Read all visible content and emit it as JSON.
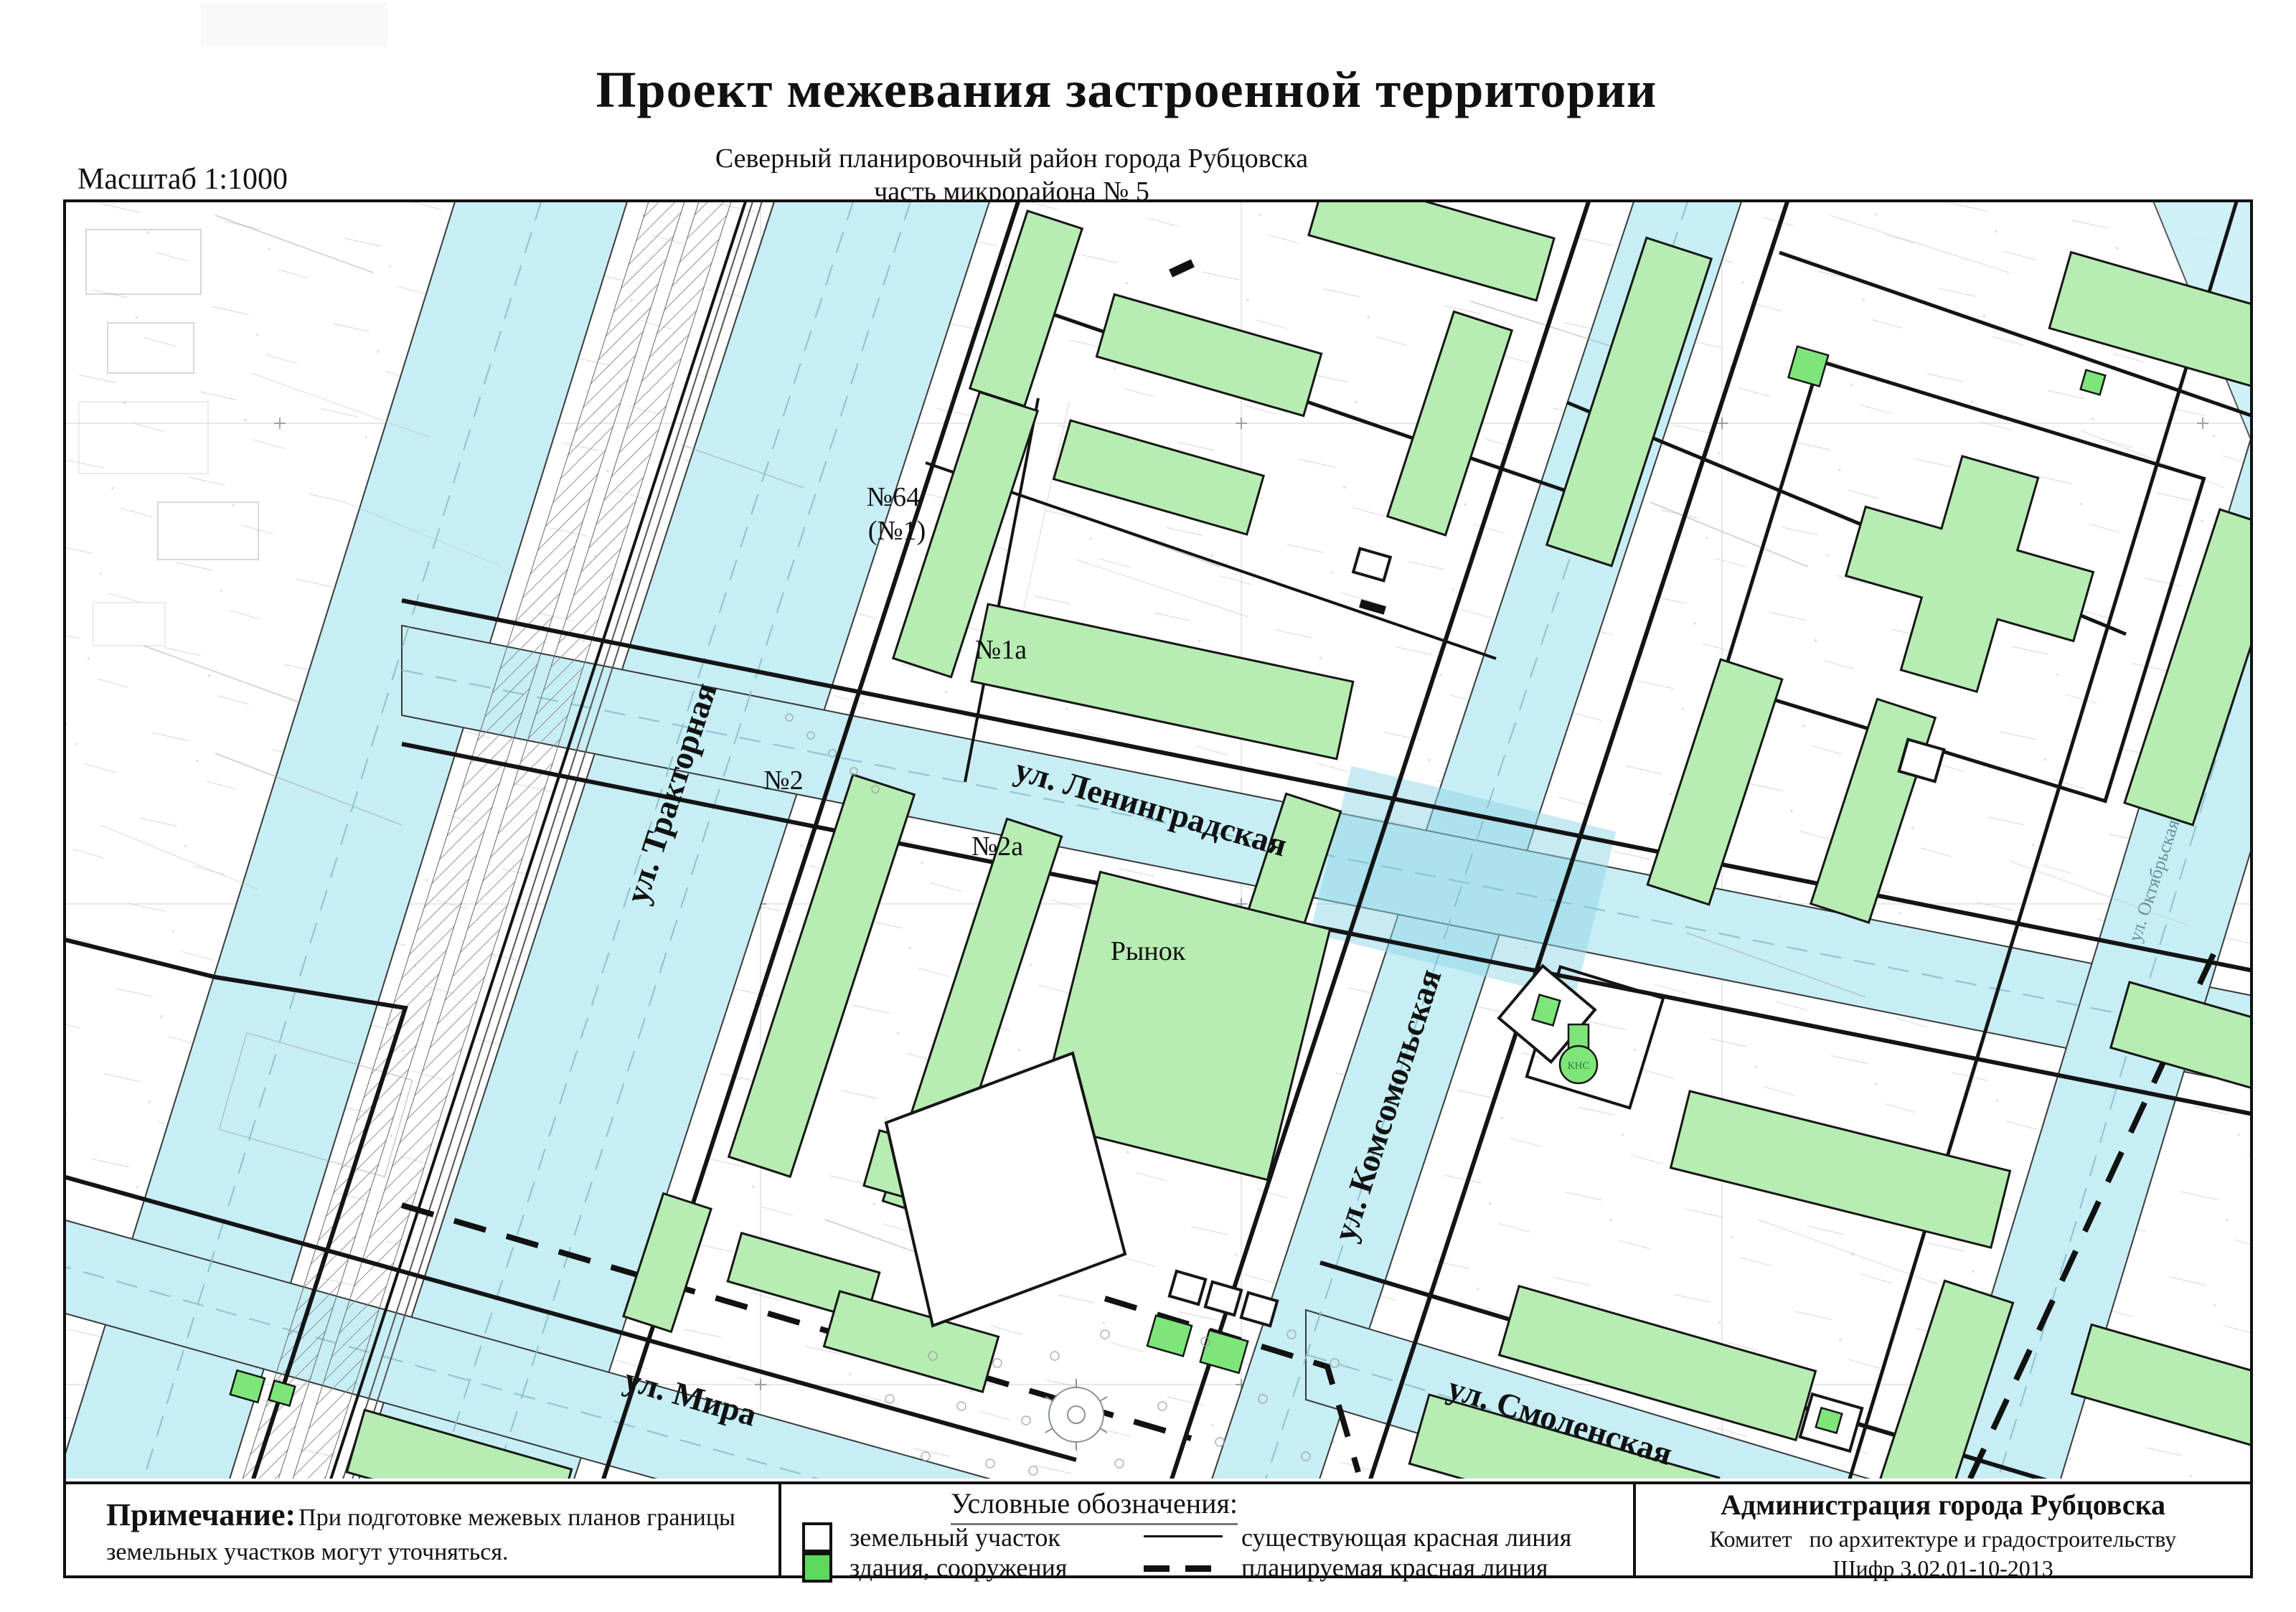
{
  "header": {
    "title": "Проект межевания застроенной территории",
    "subtitle1": "Северный планировочный район города Рубцовска",
    "subtitle2": "часть микрорайона № 5",
    "scale": "Масштаб 1:1000"
  },
  "map": {
    "streets": {
      "traktornaya": "ул. Тракторная",
      "leningradskaya": "ул. Ленинградская",
      "komsomolskaya": "ул. Комсомольская",
      "mira": "ул. Мира",
      "smolenskaya": "ул. Смоленская",
      "oktyabrskaya": "ул. Октябрьская"
    },
    "parcels": {
      "p64a": "№64",
      "p64b": "(№1)",
      "p1a": "№1а",
      "p2": "№2",
      "p2a": "№2а",
      "rynok": "Рынок",
      "kns": "КНС"
    }
  },
  "legend": {
    "title": "Условные обозначения:",
    "land_parcel": "земельный участок",
    "buildings": "здания, сооружения",
    "existing_line": "существующая красная линия",
    "planned_line": "планируемая красная линия"
  },
  "note": {
    "label": "Примечание:",
    "text1": "При подготовке межевых планов границы",
    "text2": "земельных участков могут уточняться."
  },
  "org": {
    "line1": "Администрация города Рубцовска",
    "line2": "Комитет   по архитектуре и градостроительству",
    "line3": "Шифр 3.02.01-10-2013"
  },
  "colors": {
    "street": "#c7eef5",
    "street_junction": "#8fd5e8",
    "building": "#b7edb2",
    "building_bright": "#7de57a",
    "legend_green": "#5cd95c",
    "boundary": "#141414"
  }
}
